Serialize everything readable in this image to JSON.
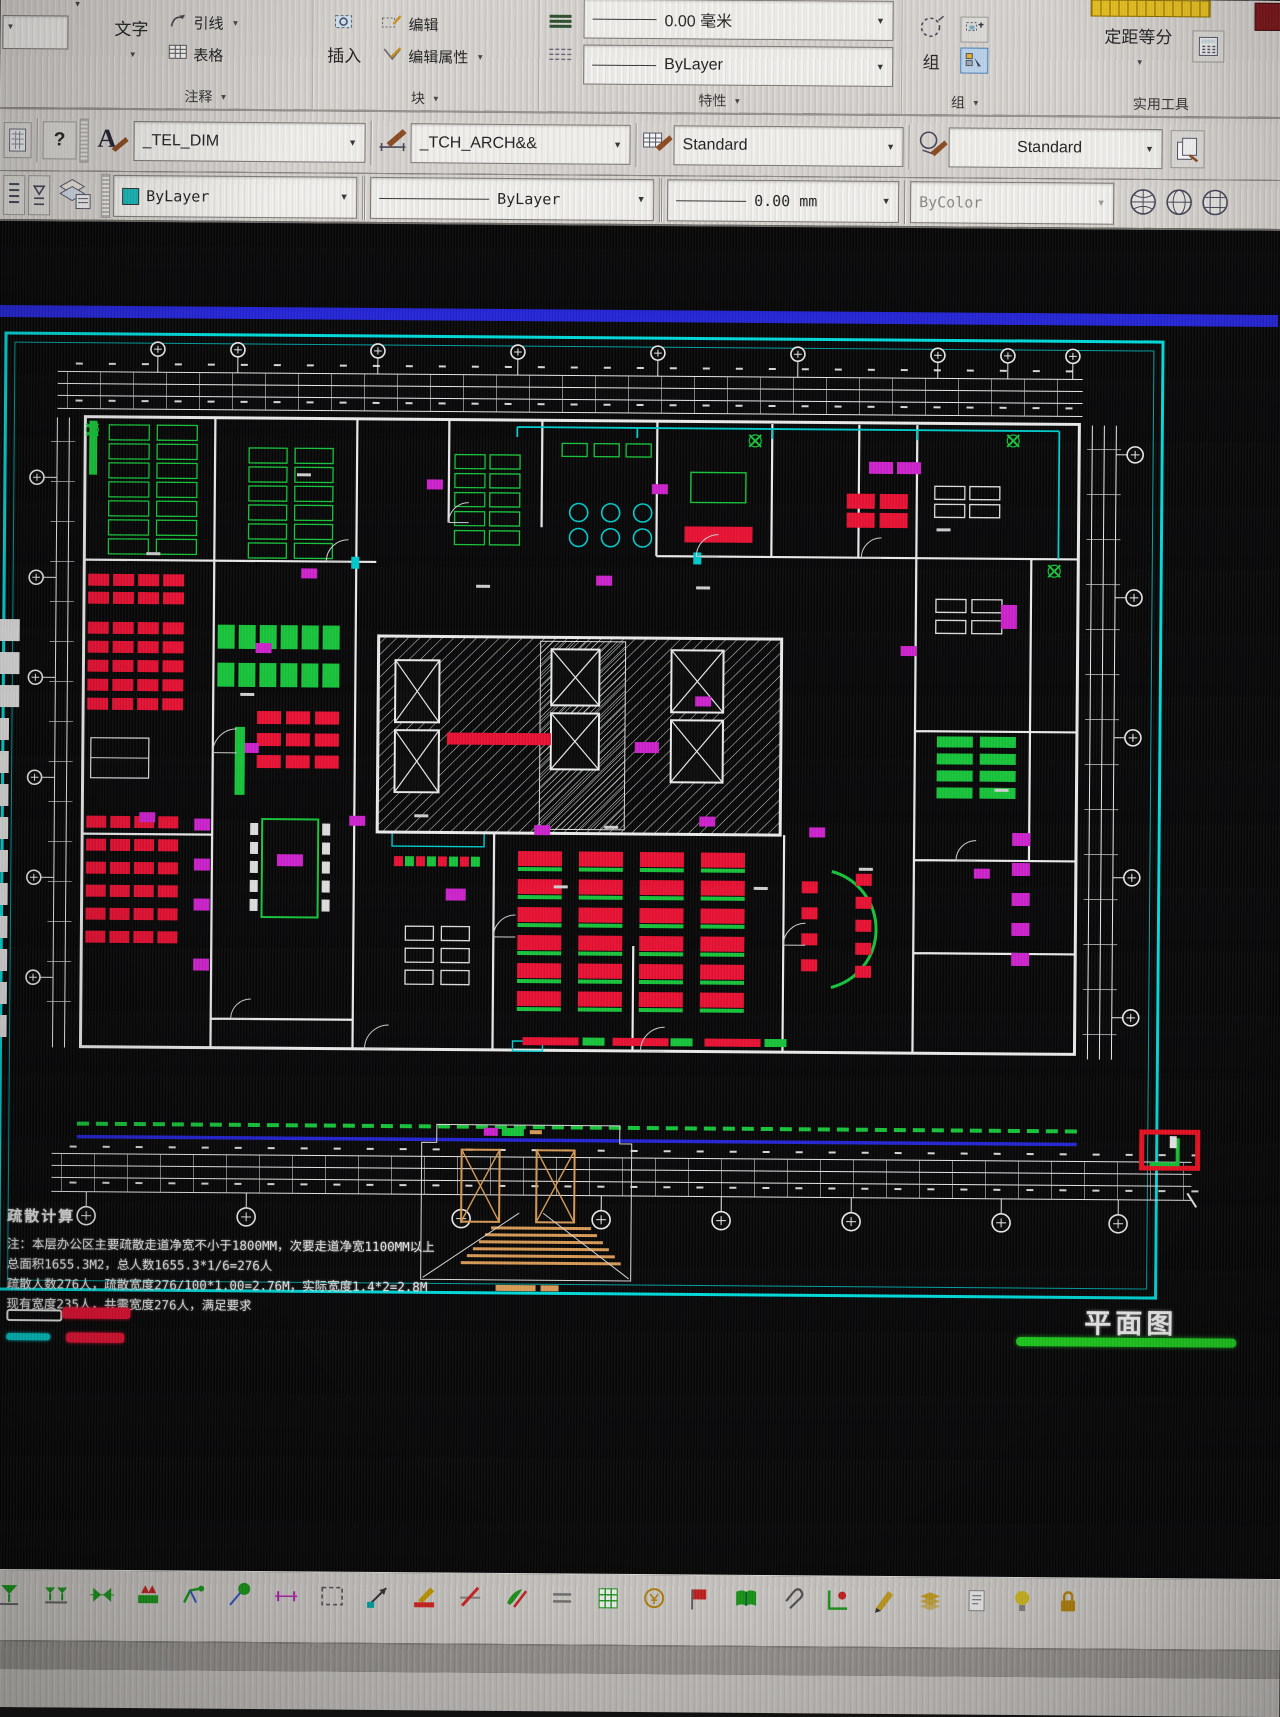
{
  "ribbon": {
    "annotate": {
      "label": "注释",
      "text_btn": "文字",
      "leader_btn": "引线",
      "table_btn": "表格"
    },
    "block": {
      "label": "块",
      "insert_btn": "插入",
      "edit_btn": "编辑",
      "edit_attr_btn": "编辑属性"
    },
    "properties": {
      "label": "特性",
      "lineweight": "0.00 毫米",
      "linetype": "ByLayer"
    },
    "group": {
      "label": "组",
      "group_btn": "组"
    },
    "utilities": {
      "label": "实用工具",
      "measure_btn": "定距等分"
    }
  },
  "quick": {
    "help": "?",
    "text_style": "_TEL_DIM",
    "dim_style": "_TCH_ARCH&&",
    "table_style": "Standard",
    "mleader_style": "Standard"
  },
  "properties_bar": {
    "color": "ByLayer",
    "linetype": "ByLayer",
    "lineweight": "0.00 mm",
    "plot_style": "ByColor"
  },
  "canvas": {
    "note_title": "疏散计算",
    "note_lines": [
      "注：本层办公区主要疏散走道净宽不小于1800MM，次要走道净宽1100MM以上",
      "总面积1655.3M2，总人数1655.3*1/6=276人",
      "疏散人数276人，疏散宽度276/100*1.00=2.76M，实际宽度1.4*2=2.8M",
      "现有宽度235人，共需宽度276人，满足要求"
    ],
    "plan_label": "平面图",
    "legend": [
      {
        "name": "legend-white-bar",
        "color": "#e9e9e9"
      },
      {
        "name": "legend-red-bar",
        "color": "#e81133"
      },
      {
        "name": "legend-cyan-bar",
        "color": "#00c8c8"
      },
      {
        "name": "legend-red-bar-2",
        "color": "#e81133"
      }
    ],
    "colors": {
      "border_cyan": "#00d9d9",
      "wall_white": "#ebebeb",
      "furniture_green": "#17c43a",
      "furniture_red": "#e81133",
      "furniture_magenta": "#cc22cc",
      "line_blue": "#2424d4",
      "detail_tan": "#d89a55",
      "underline_green": "#1ecb1e"
    }
  },
  "bottom_toolbar": {
    "icons": [
      {
        "name": "valve-icon",
        "glyph": "glass",
        "color": "#1a9c1a"
      },
      {
        "name": "double-valve-icon",
        "glyph": "glass2",
        "color": "#1a9c1a"
      },
      {
        "name": "pipe-fitting-icon",
        "glyph": "bowtie",
        "color": "#1a9c1a"
      },
      {
        "name": "pump-icon",
        "glyph": "pump",
        "color": "#1a9c1a"
      },
      {
        "name": "crane-arm-icon",
        "glyph": "arm",
        "color": "#1a9c1a"
      },
      {
        "name": "survey-pin-icon",
        "glyph": "pin",
        "color": "#1a9c1a"
      },
      {
        "name": "dimension-icon",
        "glyph": "dim",
        "color": "#bb22bb"
      },
      {
        "name": "selection-box-icon",
        "glyph": "dashrect",
        "color": "#555555"
      },
      {
        "name": "leader-arrow-icon",
        "glyph": "arrow",
        "color": "#333333"
      },
      {
        "name": "marker-icon",
        "glyph": "marker",
        "color": "#dd2222"
      },
      {
        "name": "erase-icon",
        "glyph": "slash",
        "color": "#dd2222"
      },
      {
        "name": "pen-plant-icon",
        "glyph": "pen",
        "color": "#1a9c1a"
      },
      {
        "name": "equal-lines-icon",
        "glyph": "lines",
        "color": "#777777"
      },
      {
        "name": "grid-box-icon",
        "glyph": "gridbox",
        "color": "#1a9c1a"
      },
      {
        "name": "coin-icon",
        "glyph": "coin",
        "color": "#b8860b"
      },
      {
        "name": "tag-icon",
        "glyph": "tag",
        "color": "#cc2222"
      },
      {
        "name": "book-icon",
        "glyph": "book",
        "color": "#1a9c1a"
      },
      {
        "name": "clip-icon",
        "glyph": "clip",
        "color": "#555555"
      },
      {
        "name": "component-icon",
        "glyph": "comp",
        "color": "#1a9c1a"
      },
      {
        "name": "pencil-icon",
        "glyph": "pencil",
        "color": "#c8a020"
      },
      {
        "name": "paper-stack-icon",
        "glyph": "stack",
        "color": "#c8a020"
      },
      {
        "name": "sheet-icon",
        "glyph": "sheet",
        "color": "#888888"
      },
      {
        "name": "bulb-icon",
        "glyph": "bulb",
        "color": "#d8c020"
      },
      {
        "name": "lock-icon",
        "glyph": "lock",
        "color": "#b8860b"
      }
    ]
  }
}
